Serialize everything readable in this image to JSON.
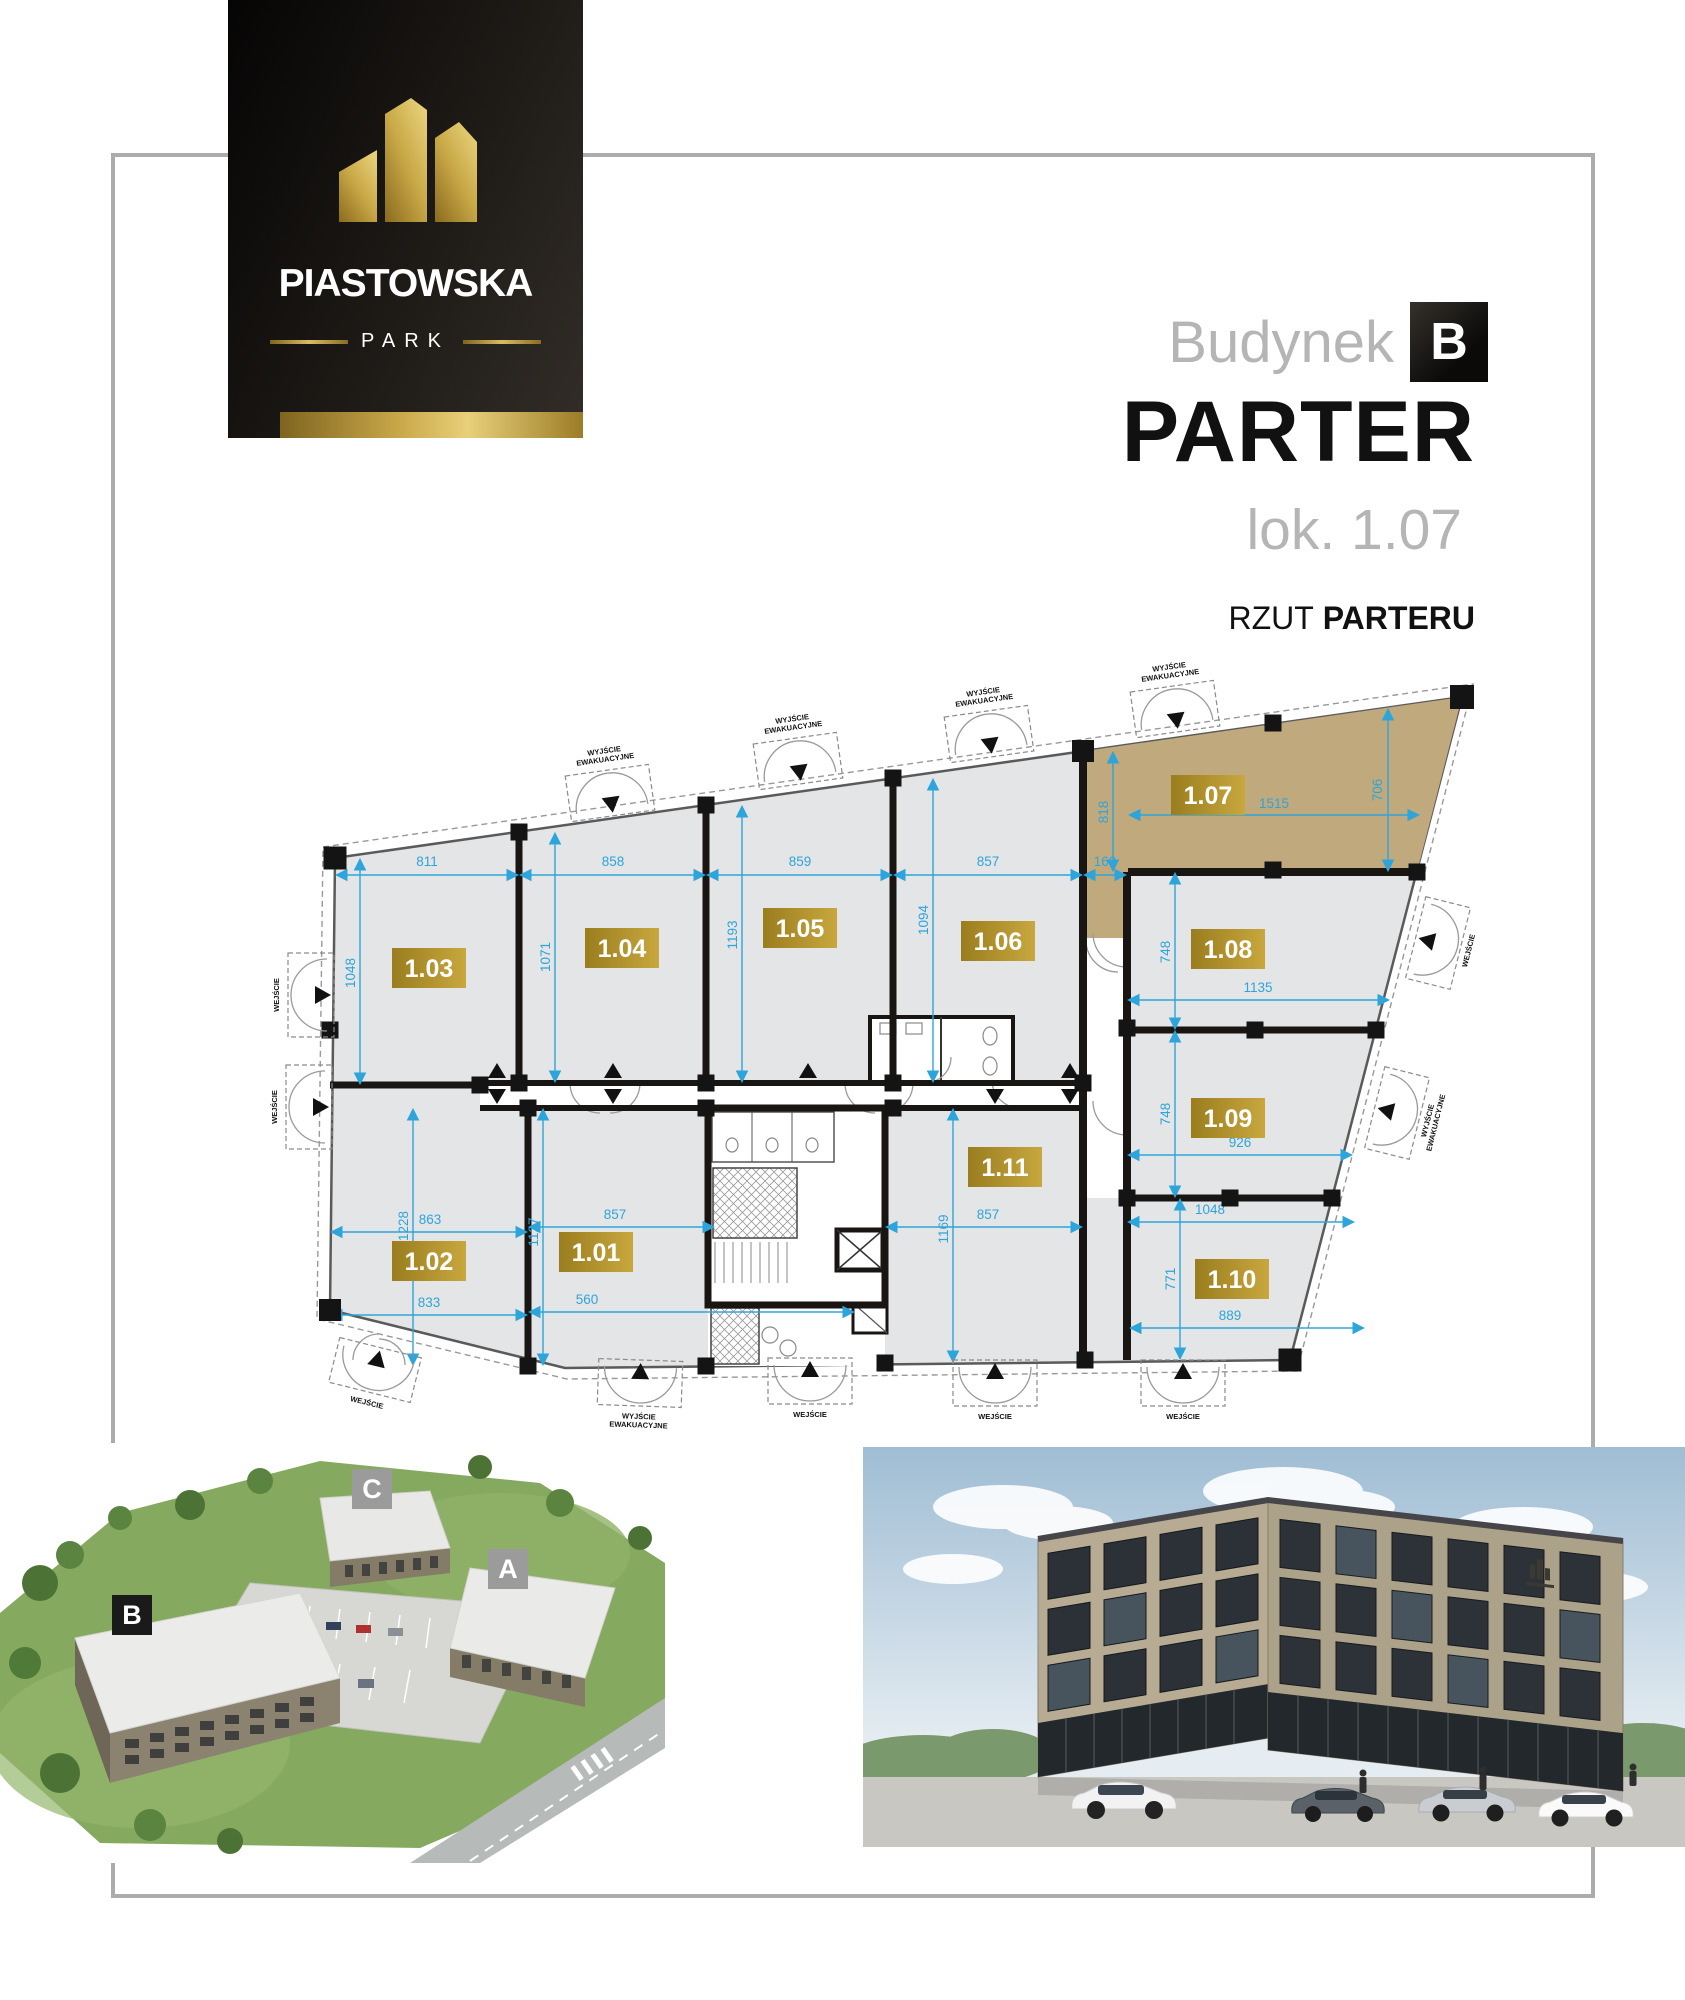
{
  "colors": {
    "gold": "#c8a73e",
    "gold_dark": "#9a7d1e",
    "tan_unit": "#c0a97c",
    "room_gray": "#e4e5e6",
    "dim_blue": "#2ea5da",
    "wall": "#181512",
    "frame_gray": "#acacac"
  },
  "logo": {
    "brand": "PIASTOWSKA",
    "sub": "PARK"
  },
  "header": {
    "building_label": "Budynek",
    "building_letter": "B",
    "floor_title": "PARTER",
    "unit": "lok. 1.07",
    "subtitle_prefix": "RZUT",
    "subtitle_bold": "PARTERU"
  },
  "plan": {
    "rooms": [
      {
        "id": "1.01",
        "cx": 371,
        "cy": 737
      },
      {
        "id": "1.02",
        "cx": 204,
        "cy": 746
      },
      {
        "id": "1.03",
        "cx": 204,
        "cy": 453
      },
      {
        "id": "1.04",
        "cx": 397,
        "cy": 433
      },
      {
        "id": "1.05",
        "cx": 575,
        "cy": 413
      },
      {
        "id": "1.06",
        "cx": 773,
        "cy": 426
      },
      {
        "id": "1.07",
        "cx": 983,
        "cy": 280,
        "highlight": true
      },
      {
        "id": "1.08",
        "cx": 1003,
        "cy": 434
      },
      {
        "id": "1.09",
        "cx": 1003,
        "cy": 603
      },
      {
        "id": "1.10",
        "cx": 1007,
        "cy": 764
      },
      {
        "id": "1.11",
        "cx": 780,
        "cy": 652
      }
    ],
    "dims_h": [
      {
        "t": "811",
        "x1": 112,
        "x2": 292,
        "y": 360,
        "lx": 202,
        "ly": 351
      },
      {
        "t": "858",
        "x1": 296,
        "x2": 479,
        "y": 360,
        "lx": 388,
        "ly": 351
      },
      {
        "t": "859",
        "x1": 483,
        "x2": 666,
        "y": 360,
        "lx": 575,
        "ly": 351
      },
      {
        "t": "857",
        "x1": 670,
        "x2": 856,
        "y": 360,
        "lx": 763,
        "ly": 351
      },
      {
        "t": "160",
        "x1": 860,
        "x2": 900,
        "y": 360,
        "lx": 880,
        "ly": 351
      },
      {
        "t": "1515",
        "x1": 905,
        "x2": 1193,
        "y": 300,
        "lx": 1049,
        "ly": 293
      },
      {
        "t": "1135",
        "x1": 904,
        "x2": 1163,
        "y": 485,
        "lx": 1033,
        "ly": 477
      },
      {
        "t": "926",
        "x1": 904,
        "x2": 1126,
        "y": 640,
        "lx": 1015,
        "ly": 632
      },
      {
        "t": "1048",
        "x1": 904,
        "x2": 1128,
        "y": 707,
        "lx": 985,
        "ly": 699
      },
      {
        "t": "889",
        "x1": 906,
        "x2": 1138,
        "y": 813,
        "lx": 1005,
        "ly": 805
      },
      {
        "t": "863",
        "x1": 107,
        "x2": 301,
        "y": 717,
        "lx": 205,
        "ly": 709
      },
      {
        "t": "857",
        "x1": 305,
        "x2": 488,
        "y": 712,
        "lx": 390,
        "ly": 704
      },
      {
        "t": "857",
        "x1": 662,
        "x2": 856,
        "y": 712,
        "lx": 763,
        "ly": 704
      },
      {
        "t": "833",
        "x1": 107,
        "x2": 301,
        "y": 800,
        "lx": 204,
        "ly": 792
      },
      {
        "t": "560",
        "x1": 305,
        "x2": 628,
        "y": 797,
        "lx": 362,
        "ly": 789
      }
    ],
    "dims_v": [
      {
        "t": "1048",
        "x": 135,
        "y1": 345,
        "y2": 568,
        "lx": 130,
        "ly": 458
      },
      {
        "t": "1071",
        "x": 330,
        "y1": 319,
        "y2": 566,
        "lx": 325,
        "ly": 442
      },
      {
        "t": "1193",
        "x": 517,
        "y1": 292,
        "y2": 566,
        "lx": 512,
        "ly": 420
      },
      {
        "t": "1094",
        "x": 708,
        "y1": 265,
        "y2": 566,
        "lx": 703,
        "ly": 405
      },
      {
        "t": "818",
        "x": 888,
        "y1": 238,
        "y2": 355,
        "lx": 883,
        "ly": 297
      },
      {
        "t": "706",
        "x": 1163,
        "y1": 195,
        "y2": 355,
        "lx": 1157,
        "ly": 275
      },
      {
        "t": "748",
        "x": 950,
        "y1": 359,
        "y2": 513,
        "lx": 945,
        "ly": 437
      },
      {
        "t": "748",
        "x": 950,
        "y1": 517,
        "y2": 681,
        "lx": 945,
        "ly": 599
      },
      {
        "t": "771",
        "x": 955,
        "y1": 685,
        "y2": 843,
        "lx": 950,
        "ly": 764
      },
      {
        "t": "1169",
        "x": 728,
        "y1": 595,
        "y2": 846,
        "lx": 723,
        "ly": 714
      },
      {
        "t": "1228",
        "x": 188,
        "y1": 595,
        "y2": 849,
        "lx": 183,
        "ly": 711
      },
      {
        "t": "1127",
        "x": 318,
        "y1": 595,
        "y2": 849,
        "lx": 313,
        "ly": 717
      }
    ],
    "doors": [
      {
        "t": "WYJŚCIE|EWAKUACYJNE",
        "x": 385,
        "y": 278,
        "r": -8,
        "side": "top"
      },
      {
        "t": "WYJŚCIE|EWAKUACYJNE",
        "x": 573,
        "y": 246,
        "r": -8,
        "side": "top"
      },
      {
        "t": "WYJŚCIE|EWAKUACYJNE",
        "x": 764,
        "y": 219,
        "r": -8,
        "side": "top"
      },
      {
        "t": "WYJŚCIE|EWAKUACYJNE",
        "x": 950,
        "y": 194,
        "r": -8,
        "side": "top"
      },
      {
        "t": "WEJŚCIE",
        "x": 86,
        "y": 480,
        "r": 0,
        "side": "left"
      },
      {
        "t": "WEJŚCIE",
        "x": 84,
        "y": 592,
        "r": 0,
        "side": "left"
      },
      {
        "t": "WEJŚCIE",
        "x": 1213,
        "y": 428,
        "r": 14,
        "side": "right"
      },
      {
        "t": "WYJŚCIE|EWAKUACYJNE",
        "x": 1172,
        "y": 598,
        "r": 14,
        "side": "right"
      },
      {
        "t": "WEJŚCIE",
        "x": 150,
        "y": 855,
        "r": 14,
        "side": "bottom"
      },
      {
        "t": "WYJŚCIE|EWAKUACYJNE",
        "x": 415,
        "y": 868,
        "r": 2,
        "side": "bottom"
      },
      {
        "t": "WEJŚCIE",
        "x": 585,
        "y": 866,
        "r": 0,
        "side": "bottom"
      },
      {
        "t": "WEJŚCIE",
        "x": 770,
        "y": 868,
        "r": 0,
        "side": "bottom"
      },
      {
        "t": "WEJŚCIE",
        "x": 958,
        "y": 868,
        "r": 0,
        "side": "bottom"
      }
    ],
    "arrows": [
      {
        "x": 272,
        "y": 556,
        "d": "up"
      },
      {
        "x": 272,
        "y": 581,
        "d": "down"
      },
      {
        "x": 388,
        "y": 556,
        "d": "up"
      },
      {
        "x": 388,
        "y": 581,
        "d": "down"
      },
      {
        "x": 583,
        "y": 556,
        "d": "up"
      },
      {
        "x": 770,
        "y": 581,
        "d": "down"
      },
      {
        "x": 845,
        "y": 556,
        "d": "up"
      },
      {
        "x": 845,
        "y": 581,
        "d": "down"
      }
    ],
    "columns": [
      [
        110,
        343,
        23
      ],
      [
        294,
        317
      ],
      [
        481,
        290
      ],
      [
        668,
        263
      ],
      [
        858,
        236,
        22
      ],
      [
        1048,
        208
      ],
      [
        1237,
        182,
        24
      ],
      [
        105,
        515
      ],
      [
        105,
        795,
        22
      ],
      [
        255,
        570
      ],
      [
        294,
        568
      ],
      [
        303,
        593
      ],
      [
        303,
        851
      ],
      [
        481,
        568
      ],
      [
        481,
        593
      ],
      [
        668,
        568
      ],
      [
        668,
        593
      ],
      [
        858,
        568
      ],
      [
        860,
        845
      ],
      [
        481,
        851
      ],
      [
        660,
        848
      ],
      [
        1065,
        845,
        23
      ],
      [
        1192,
        357
      ],
      [
        1151,
        515
      ],
      [
        1107,
        683
      ],
      [
        1048,
        355
      ],
      [
        1030,
        515
      ],
      [
        1005,
        683
      ],
      [
        902,
        513
      ],
      [
        902,
        683
      ]
    ]
  },
  "site": {
    "b": "B",
    "c": "C",
    "a": "A"
  }
}
